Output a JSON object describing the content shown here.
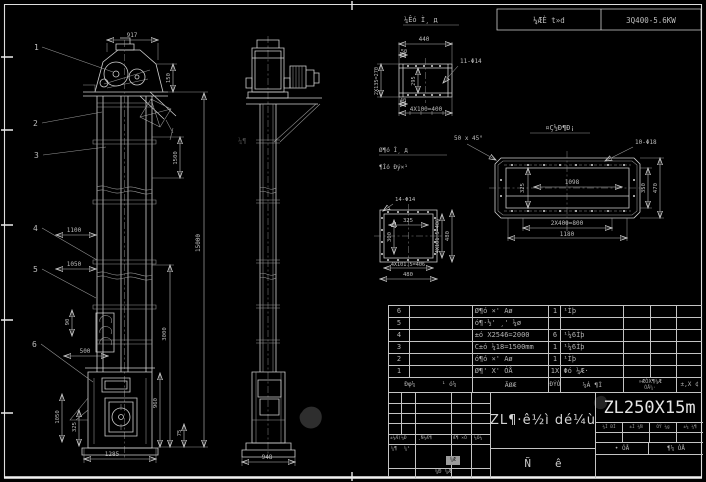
{
  "colors": {
    "background": "#000000",
    "line": "#cfcfcf",
    "text": "#bdbdbd",
    "bright": "#e6e6e6"
  },
  "watermark": "¼¶",
  "top_bar": {
    "floating_label": "¼Êó Ì¸ д",
    "cell_left": "¼ÆÈ t»d",
    "cell_right": "3Q400-5.6KW"
  },
  "callouts": [
    "1",
    "2",
    "3",
    "4",
    "5",
    "6"
  ],
  "front_view_dims": {
    "overall_width": "917",
    "head": "150",
    "section": "1500",
    "total_height": "15000",
    "lower": "3000",
    "boot_height": "960",
    "base": "75",
    "w1": "1100",
    "w2": "1050",
    "door": "90",
    "inlet": "500",
    "v1050": "1050",
    "v325": "325",
    "base_width": "1285"
  },
  "side_view_dims": {
    "base_width": "948"
  },
  "detail_top_flange": {
    "top": "440",
    "d50": "50",
    "left": "2X135=270",
    "inner": "295",
    "d40": "40",
    "bottom": "4X100=400",
    "holes_note": "11-Φ14"
  },
  "chamfer_note": "50 x 45°",
  "detail_long_box": {
    "title": "¤Ç½Ð¶Ð¡",
    "holes_note": "10-Φ18",
    "inner": "1098",
    "left": "325",
    "right_inner": "350",
    "right_outer": "470",
    "bottom_inner": "2X400=800",
    "bottom_outer": "1180"
  },
  "detail_square_flange": {
    "label_line1": "Ø¶ó Ì¸ д",
    "label_line2": "¶Ìó Ðý×¹",
    "holes_note": "14-Φ14",
    "inner_width": "325",
    "inner_height": "300",
    "right_inner": "4X101.5=406",
    "right_outer": "480",
    "bottom_inner": "4X101.5=406",
    "bottom_outer": "480"
  },
  "parts_table": {
    "header": {
      "c1": "Ðφ¼",
      "c2": "¹ ó¼",
      "c3": "ÃØÆ",
      "c4": "ÐÝÒ",
      "c5": "¼Á ¶Ì",
      "c6a": "»ÆÒX¶¼Æ",
      "c6b": "ÓÅ¼·",
      "c7": "±,X ¢"
    },
    "rows": [
      {
        "num": "6",
        "col2": "",
        "desc": "Ø¶ó ×' Aø",
        "qty": "1",
        "mat": "¹Ìþ"
      },
      {
        "num": "5",
        "col2": "",
        "desc": "ó¶·½' ¸' ¼ø",
        "qty": "",
        "mat": ""
      },
      {
        "num": "4",
        "col2": "",
        "desc": "±ó X2546=2000",
        "qty": "6",
        "mat": "¹¼6Ìþ"
      },
      {
        "num": "3",
        "col2": "",
        "desc": "C±ó ¼18=1500mm",
        "qty": "1",
        "mat": "¹¼6Ìþ"
      },
      {
        "num": "2",
        "col2": "",
        "desc": "ó¶ó ×' Aø",
        "qty": "1",
        "mat": "¹Ìþ"
      },
      {
        "num": "1",
        "col2": "",
        "desc": "Ø¶' X' ÓÅ",
        "qty": "1X",
        "mat": "Φó ¼Æ·"
      }
    ]
  },
  "title_block": {
    "sig1": "±¼Æ(¼Ð",
    "sig2": "¸Ñ¼Æ¶",
    "sig3": "Æ¶ ×Ó",
    "sig4": "¼Ó¼",
    "sig5": "¼¶",
    "sig6": "¼¹",
    "stamp": "¼Æ",
    "stamp_label": "¼Ð ¼Æ",
    "name": "ZL¶·ê½ì dé¼ù",
    "type_left": "Ñ",
    "type_right": "ê",
    "model": "ZL250X15m",
    "attr1": "¼Ì ÐÌ",
    "attr2": "±Ì ¼Ñ",
    "attr3": "ÓÝ ¼g",
    "attr4": "±¼ ¼¶",
    "scale_left": "• ÓÅ",
    "scale_right": "¶¼ ÓÅ"
  }
}
